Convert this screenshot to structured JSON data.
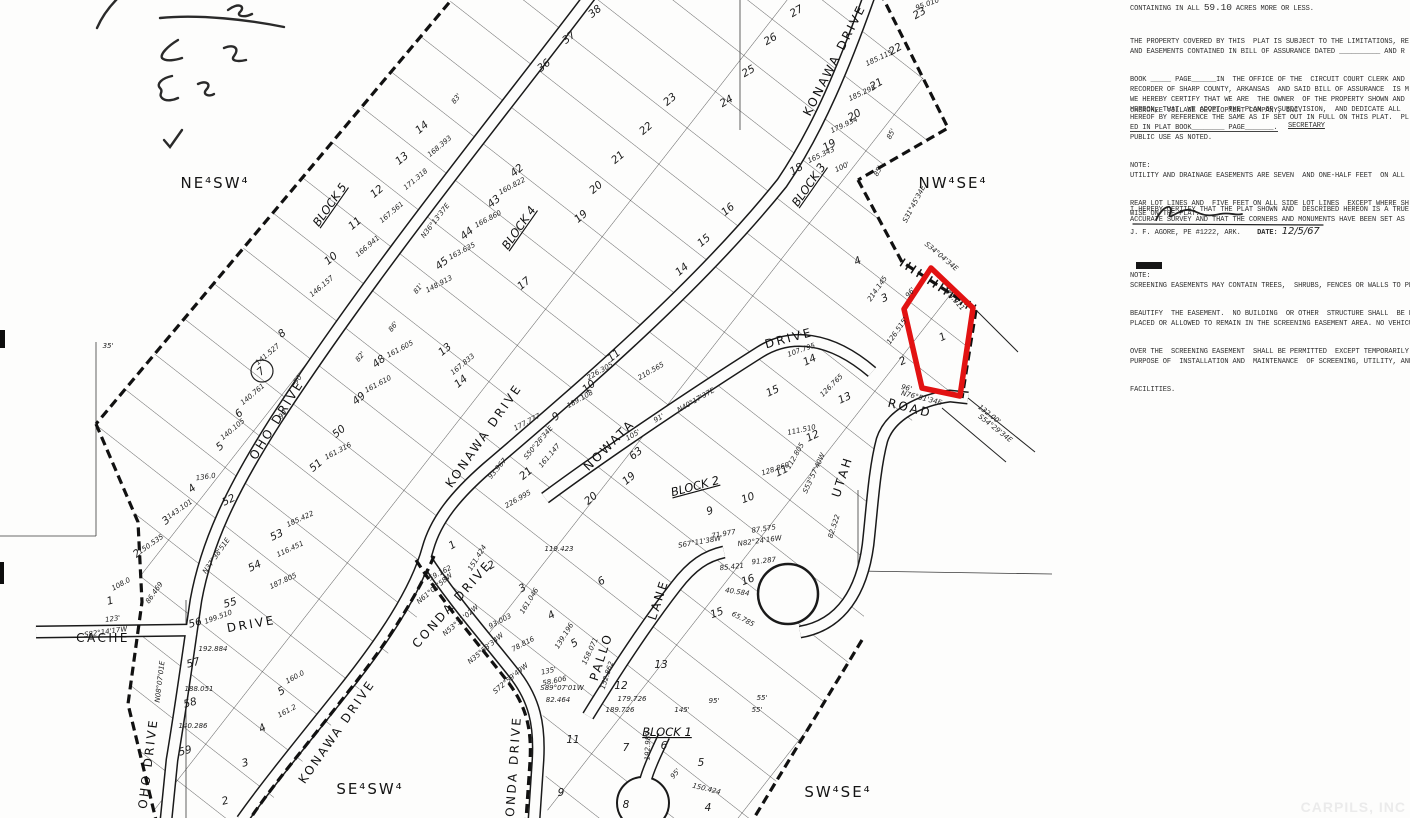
{
  "panel": {
    "containing_prefix": "CONTAINING IN ALL ",
    "acres": "59.10",
    "containing_suffix": " ACRES MORE OR LESS.",
    "par_b": {
      "lines": [
        "THE PROPERTY COVERED BY THIS  PLAT IS SUBJECT TO THE LIMITATIONS, RE",
        "AND EASEMENTS CONTAINED IN BILL OF ASSURANCE DATED __________ AND R",
        "BOOK _____ PAGE______IN  THE OFFICE OF THE  CIRCUIT COURT CLERK AND",
        "RECORDER OF SHARP COUNTY, ARKANSAS  AND SAID BILL OF ASSURANCE  IS M",
        "HEREOF BY REFERENCE THE SAME AS IF SET OUT IN FULL ON THIS PLAT.  PL",
        "ED IN PLAT BOOK________ PAGE_______."
      ]
    },
    "par_c": {
      "lines": [
        "WE HEREBY CERTIFY THAT WE ARE  THE OWNER  OF THE PROPERTY SHOWN AND",
        "HEREON, THAT  WE ADOPT  THE PLAN OF SUBDIVISION,  AND DEDICATE ALL",
        "PUBLIC USE AS NOTED."
      ]
    },
    "company": "CHEROKEE VILLAGE DEVELOPMENT COMPANY, INC.",
    "secretary_label": "SECRETARY",
    "note_d": {
      "lines": [
        "NOTE:",
        "UTILITY AND DRAINAGE EASEMENTS ARE SEVEN  AND ONE-HALF FEET  ON ALL",
        "REAR LOT LINES AND  FIVE FEET ON ALL SIDE LOT LINES  EXCEPT WHERE SH",
        "WISE ON THE PLAT."
      ]
    },
    "par_e": {
      "lines": [
        "I HEREBY CERTIFY THAT THE PLAT SHOWN AND  DESCRIBED HEREON IS A TRUE",
        "ACCURATE SURVEY AND THAT THE CORNERS AND MONUMENTS HAVE BEEN SET AS"
      ]
    },
    "surveyor_line": "J. F. AGORE, PE #1222, ARK.",
    "date_label": "DATE:",
    "date_value": "12/5/67",
    "note_f": {
      "lines": [
        "NOTE:",
        "SCREENING EASEMENTS MAY CONTAIN TREES,  SHRUBS, FENCES OR WALLS TO PRO",
        "BEAUTIFY  THE EASEMENT.  NO BUILDING  OR OTHER  STRUCTURE SHALL  BE ER",
        "PLACED OR ALLOWED TO REMAIN IN THE SCREENING EASEMENT AREA. NO VEHICUL",
        "OVER THE  SCREENING EASEMENT  SHALL BE PERMITTED  EXCEPT TEMPORARILY",
        "PURPOSE OF  INSTALLATION AND  MAINTENANCE  OF SCREENING, UTILITY, AND",
        "FACILITIES."
      ]
    }
  },
  "map": {
    "red_parcel": {
      "points": "931,268 973,308 960,396 922,388 904,309",
      "color": "#e21212",
      "lot_number": "1"
    },
    "quarter_labels": [
      [
        "NE⁴SW⁴",
        215,
        188
      ],
      [
        "NW⁴SE⁴",
        953,
        188
      ],
      [
        "SE⁴SW⁴",
        370,
        794
      ],
      [
        "SW⁴SE⁴",
        838,
        797
      ]
    ],
    "block_labels": [
      [
        "BLOCK 5",
        333,
        207,
        -55
      ],
      [
        "BLOCK 4",
        522,
        230,
        -55
      ],
      [
        "BLOCK 3",
        812,
        187,
        -55
      ],
      [
        "BLOCK 2",
        696,
        490,
        -15
      ],
      [
        "BLOCK 1",
        667,
        736,
        0
      ]
    ],
    "street_labels": [
      [
        "KONAWA DRIVE",
        838,
        62,
        -63
      ],
      [
        "OHO DRIVE",
        280,
        422,
        -58
      ],
      [
        "KONAWA DRIVE",
        487,
        438,
        -55
      ],
      [
        "NOWATA",
        612,
        448,
        -45
      ],
      [
        "DRIVE",
        790,
        342,
        -15
      ],
      [
        "UTAH",
        846,
        478,
        -72
      ],
      [
        "ROAD",
        909,
        412,
        14
      ],
      [
        "CONDA DRIVE",
        455,
        607,
        -48
      ],
      [
        "CACHE",
        103,
        642,
        0
      ],
      [
        "DRIVE",
        252,
        628,
        -10
      ],
      [
        "PALLO",
        605,
        658,
        -72
      ],
      [
        "LANE",
        662,
        601,
        -72
      ],
      [
        "OHO DRIVE",
        152,
        764,
        -83
      ],
      [
        "KONAWA DRIVE",
        340,
        734,
        -55
      ],
      [
        "CONDA DRIVE",
        517,
        772,
        -86
      ]
    ],
    "lot_numbers": [
      [
        "27",
        798,
        14,
        -30
      ],
      [
        "23",
        921,
        16,
        -30
      ],
      [
        "22",
        897,
        52,
        -30
      ],
      [
        "21",
        878,
        87,
        -30
      ],
      [
        "20",
        856,
        118,
        -30
      ],
      [
        "19",
        831,
        148,
        -30
      ],
      [
        "18",
        798,
        172,
        -30
      ],
      [
        "26",
        772,
        42,
        -30
      ],
      [
        "25",
        750,
        74,
        -30
      ],
      [
        "24",
        728,
        104,
        -30
      ],
      [
        "14",
        424,
        130
      ],
      [
        "13",
        404,
        161
      ],
      [
        "12",
        379,
        194
      ],
      [
        "11",
        357,
        226
      ],
      [
        "10",
        333,
        261
      ],
      [
        "42",
        519,
        173
      ],
      [
        "43",
        496,
        204
      ],
      [
        "44",
        469,
        236
      ],
      [
        "45",
        444,
        266
      ],
      [
        "17",
        526,
        286
      ],
      [
        "37",
        571,
        40
      ],
      [
        "36",
        546,
        68
      ],
      [
        "38",
        597,
        14
      ],
      [
        "23",
        672,
        102
      ],
      [
        "22",
        648,
        131
      ],
      [
        "21",
        620,
        160
      ],
      [
        "20",
        598,
        190
      ],
      [
        "19",
        583,
        219
      ],
      [
        "16",
        730,
        212
      ],
      [
        "15",
        706,
        243
      ],
      [
        "14",
        684,
        272
      ],
      [
        "8",
        284,
        336
      ],
      [
        "7",
        263,
        374
      ],
      [
        "6",
        241,
        416
      ],
      [
        "5",
        222,
        449
      ],
      [
        "48",
        381,
        364
      ],
      [
        "49",
        361,
        401
      ],
      [
        "50",
        341,
        434
      ],
      [
        "51",
        318,
        468
      ],
      [
        "52",
        230,
        503,
        -25
      ],
      [
        "53",
        278,
        538,
        -25
      ],
      [
        "54",
        256,
        569,
        -25
      ],
      [
        "4",
        194,
        491
      ],
      [
        "3",
        168,
        523
      ],
      [
        "2",
        139,
        556
      ],
      [
        "13",
        447,
        352
      ],
      [
        "14",
        463,
        384
      ],
      [
        "9",
        558,
        419
      ],
      [
        "10",
        591,
        389
      ],
      [
        "11",
        616,
        358
      ],
      [
        "21",
        528,
        476
      ],
      [
        "63",
        638,
        456
      ],
      [
        "19",
        631,
        481
      ],
      [
        "20",
        593,
        501
      ],
      [
        "15",
        774,
        394,
        -25
      ],
      [
        "14",
        811,
        363,
        -25
      ],
      [
        "13",
        846,
        401,
        -25
      ],
      [
        "12",
        814,
        439,
        -25
      ],
      [
        "11",
        783,
        474,
        -25
      ],
      [
        "2",
        904,
        364,
        -25
      ],
      [
        "3",
        886,
        301,
        -25
      ],
      [
        "4",
        859,
        264,
        -25
      ],
      [
        "1",
        944,
        340,
        -25
      ],
      [
        "9",
        711,
        514,
        -20
      ],
      [
        "10",
        749,
        501,
        -20
      ],
      [
        "16",
        749,
        583,
        -20
      ],
      [
        "15",
        718,
        616,
        -20
      ],
      [
        "1",
        454,
        548,
        -30
      ],
      [
        "2",
        493,
        568,
        -30
      ],
      [
        "3",
        524,
        591,
        -30
      ],
      [
        "4",
        553,
        618,
        -30
      ],
      [
        "5",
        576,
        646,
        -30
      ],
      [
        "6",
        603,
        584,
        -30
      ],
      [
        "12",
        621,
        689,
        0
      ],
      [
        "13",
        661,
        668,
        0
      ],
      [
        "11",
        573,
        743,
        0
      ],
      [
        "7",
        626,
        751,
        0
      ],
      [
        "6",
        664,
        749,
        0
      ],
      [
        "5",
        701,
        766,
        0
      ],
      [
        "9",
        561,
        796,
        0
      ],
      [
        "8",
        626,
        808,
        0
      ],
      [
        "4",
        708,
        811,
        0
      ],
      [
        "55",
        231,
        606,
        -15
      ],
      [
        "56",
        196,
        626,
        -15
      ],
      [
        "57",
        194,
        666,
        -15
      ],
      [
        "58",
        191,
        706,
        -15
      ],
      [
        "59",
        186,
        754,
        -15
      ],
      [
        "3",
        246,
        766,
        -15
      ],
      [
        "2",
        226,
        804,
        -15
      ],
      [
        "1",
        111,
        604,
        -15
      ],
      [
        "5",
        283,
        694,
        -30
      ],
      [
        "4",
        264,
        731,
        -30
      ]
    ],
    "measurements": [
      [
        "95.010",
        928,
        6,
        -20
      ],
      [
        "185.115",
        880,
        60,
        -25
      ],
      [
        "185.295",
        863,
        95,
        -25
      ],
      [
        "179.934",
        845,
        127,
        -25
      ],
      [
        "165.343",
        822,
        157,
        -25
      ],
      [
        "S31°45'34E",
        916,
        205,
        -62
      ],
      [
        "85'",
        893,
        135,
        -62
      ],
      [
        "85'",
        880,
        172,
        -62
      ],
      [
        "100'",
        843,
        169,
        -25
      ],
      [
        "168.393",
        441,
        148,
        -40
      ],
      [
        "171.318",
        417,
        181,
        -40
      ],
      [
        "167.561",
        393,
        214,
        -40
      ],
      [
        "166.941",
        369,
        248,
        -40
      ],
      [
        "146.157",
        323,
        288,
        -40
      ],
      [
        "160.822",
        513,
        188,
        -28
      ],
      [
        "166.860",
        489,
        221,
        -28
      ],
      [
        "163.635",
        463,
        253,
        -28
      ],
      [
        "148.913",
        440,
        286,
        -28
      ],
      [
        "N36°13'37E",
        437,
        222,
        -52
      ],
      [
        "83'",
        458,
        100,
        -52
      ],
      [
        "81'",
        420,
        290,
        -52
      ],
      [
        "86'",
        395,
        328,
        -52
      ],
      [
        "141.527",
        269,
        356,
        -40
      ],
      [
        "140.761",
        254,
        396,
        -40
      ],
      [
        "140.105",
        234,
        431,
        -40
      ],
      [
        "161.605",
        401,
        351,
        -28
      ],
      [
        "161.610",
        379,
        386,
        -28
      ],
      [
        "161.316",
        339,
        453,
        -28
      ],
      [
        "90'",
        300,
        380,
        -52
      ],
      [
        "90'",
        285,
        415,
        -52
      ],
      [
        "82'",
        362,
        358,
        -52
      ],
      [
        "167.833",
        464,
        366,
        -40
      ],
      [
        "226.305",
        601,
        373,
        -30
      ],
      [
        "189.108",
        581,
        401,
        -30
      ],
      [
        "105'",
        634,
        437,
        -30
      ],
      [
        "91'",
        660,
        420,
        -30
      ],
      [
        "177.777",
        528,
        424,
        -28
      ],
      [
        "S50°28'34E",
        540,
        444,
        -50
      ],
      [
        "161.147",
        551,
        457,
        -50
      ],
      [
        "93.967",
        499,
        470,
        -50
      ],
      [
        "226.995",
        519,
        501,
        -30
      ],
      [
        "N40°17'37E",
        697,
        402,
        -30
      ],
      [
        "210.565",
        652,
        373,
        -30
      ],
      [
        "107.795",
        802,
        352,
        -20
      ],
      [
        "126.765",
        833,
        387,
        -45
      ],
      [
        "111.510",
        802,
        432,
        -12
      ],
      [
        "112.805",
        797,
        457,
        -60
      ],
      [
        "128.860",
        776,
        471,
        -18
      ],
      [
        "S53°57'40W",
        816,
        474,
        -65
      ],
      [
        "S34°04'34E",
        940,
        258,
        40
      ],
      [
        "173.911",
        952,
        300,
        48
      ],
      [
        "214.145",
        879,
        290,
        -55
      ],
      [
        "126.515'",
        899,
        332,
        -55
      ],
      [
        "96'",
        912,
        294,
        -50
      ],
      [
        "96'",
        906,
        390,
        14
      ],
      [
        "N76°51'34E",
        921,
        400,
        14
      ],
      [
        "132.00'",
        988,
        416,
        38
      ],
      [
        "S54°29'34E",
        994,
        430,
        38
      ],
      [
        "82.522",
        836,
        527,
        -72
      ],
      [
        "S67°11'38W",
        700,
        544,
        -10
      ],
      [
        "87.575",
        764,
        531,
        -8
      ],
      [
        "N82°24'16W",
        760,
        543,
        -8
      ],
      [
        "85.421",
        732,
        569,
        -6
      ],
      [
        "91.287",
        764,
        563,
        -6
      ],
      [
        "71.977",
        724,
        536,
        -10
      ],
      [
        "40.584",
        737,
        594,
        8
      ],
      [
        "65.785",
        742,
        621,
        28
      ],
      [
        "59.162",
        441,
        575,
        -28
      ],
      [
        "151.424",
        479,
        559,
        -58
      ],
      [
        "119.423",
        559,
        551,
        0
      ],
      [
        "161.046",
        531,
        602,
        -58
      ],
      [
        "139.196",
        566,
        637,
        -58
      ],
      [
        "93.003",
        501,
        623,
        -28
      ],
      [
        "78.816",
        524,
        646,
        -28
      ],
      [
        "135'",
        549,
        673,
        -12
      ],
      [
        "58.606",
        555,
        683,
        -12
      ],
      [
        "N61°00'58W",
        436,
        590,
        -40
      ],
      [
        "N53°31'02W",
        462,
        622,
        -40
      ],
      [
        "N35°53'34W",
        487,
        650,
        -40
      ],
      [
        "S72°59'49W",
        512,
        680,
        -40
      ],
      [
        "S89°07'01W",
        562,
        690,
        0
      ],
      [
        "82.464",
        558,
        702,
        0
      ],
      [
        "179.726",
        632,
        701,
        0
      ],
      [
        "189.726",
        620,
        712,
        0
      ],
      [
        "145'",
        682,
        712,
        0
      ],
      [
        "95'",
        714,
        703,
        0
      ],
      [
        "55'",
        762,
        700,
        0
      ],
      [
        "55'",
        757,
        712,
        0
      ],
      [
        "152.862",
        609,
        676,
        -72
      ],
      [
        "158.071",
        592,
        652,
        -65
      ],
      [
        "192.989",
        650,
        746,
        -88
      ],
      [
        "150.424",
        706,
        791,
        14
      ],
      [
        "95'",
        677,
        775,
        -50
      ],
      [
        "123'",
        113,
        621,
        -8
      ],
      [
        "S82°14'17W",
        106,
        634,
        -8
      ],
      [
        "199.510",
        219,
        619,
        -20
      ],
      [
        "192.884",
        213,
        651,
        0
      ],
      [
        "188.051",
        199,
        691,
        0
      ],
      [
        "140.286",
        193,
        728,
        0
      ],
      [
        "N08°07'01E",
        162,
        682,
        -83
      ],
      [
        "143.101",
        181,
        511,
        -35
      ],
      [
        "150.535",
        152,
        546,
        -35
      ],
      [
        "136.0",
        206,
        479,
        -8
      ],
      [
        "108.0",
        122,
        586,
        -28
      ],
      [
        "N37°38'51E",
        218,
        557,
        -55
      ],
      [
        "86.469",
        156,
        594,
        -55
      ],
      [
        "116.451",
        291,
        551,
        -25
      ],
      [
        "185.422",
        301,
        521,
        -25
      ],
      [
        "187.805",
        284,
        583,
        -25
      ],
      [
        "160.0",
        296,
        679,
        -28
      ],
      [
        "161.2",
        288,
        713,
        -28
      ],
      [
        "35'",
        108,
        348,
        0
      ]
    ],
    "watermark": "CARPILS, INC"
  }
}
